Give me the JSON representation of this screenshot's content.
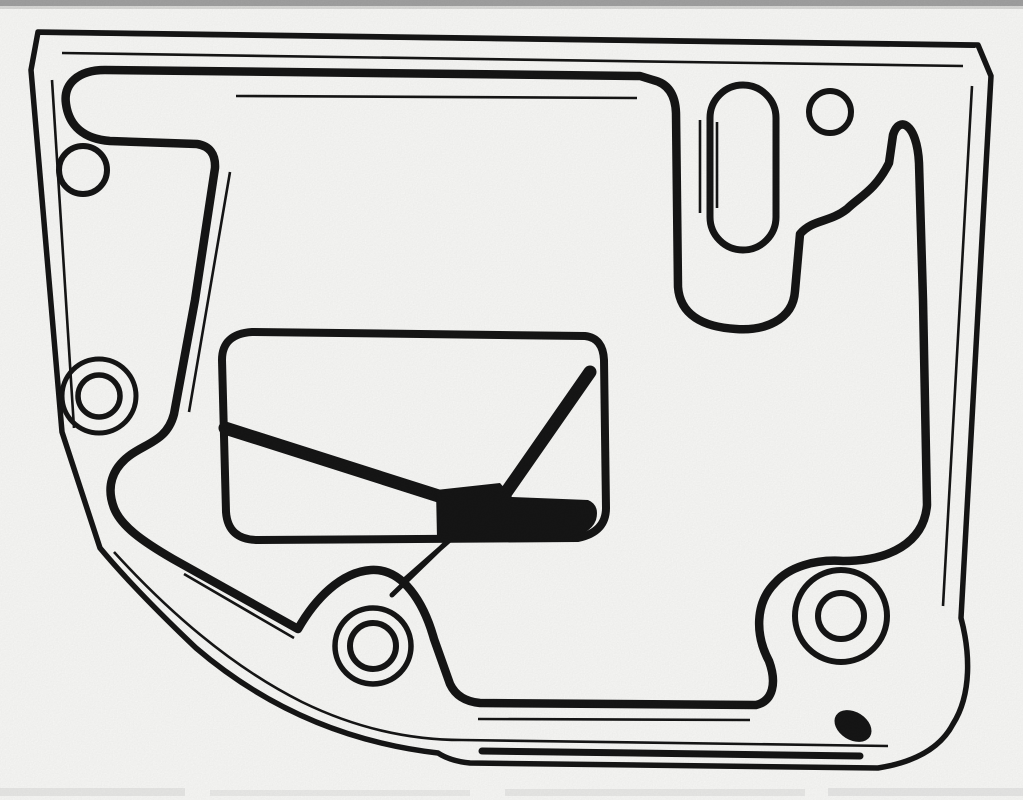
{
  "canvas": {
    "width": 1023,
    "height": 800,
    "background": "#fbfbf9",
    "ink": "#161616",
    "scan_artifact_gray": "#8d8d8d"
  },
  "figure": {
    "kind": "monochrome scanned line drawing",
    "subject": "flat gasket / filter plate viewed face-on",
    "features": [
      "plate-outline",
      "plate-edge-inner-line",
      "gasket-bead",
      "gasket-bead-companion-lines",
      "top-left-hook",
      "top-right-u-channel",
      "slot-opening-top-right",
      "bolt-hole-top-left",
      "bolt-hole-left",
      "bolt-hole-top-right",
      "bolt-hole-bottom-center",
      "bolt-hole-bottom-right",
      "inlet-panel",
      "inlet-v-stripes",
      "inlet-connector-tube",
      "scan-edge-artifacts"
    ]
  }
}
